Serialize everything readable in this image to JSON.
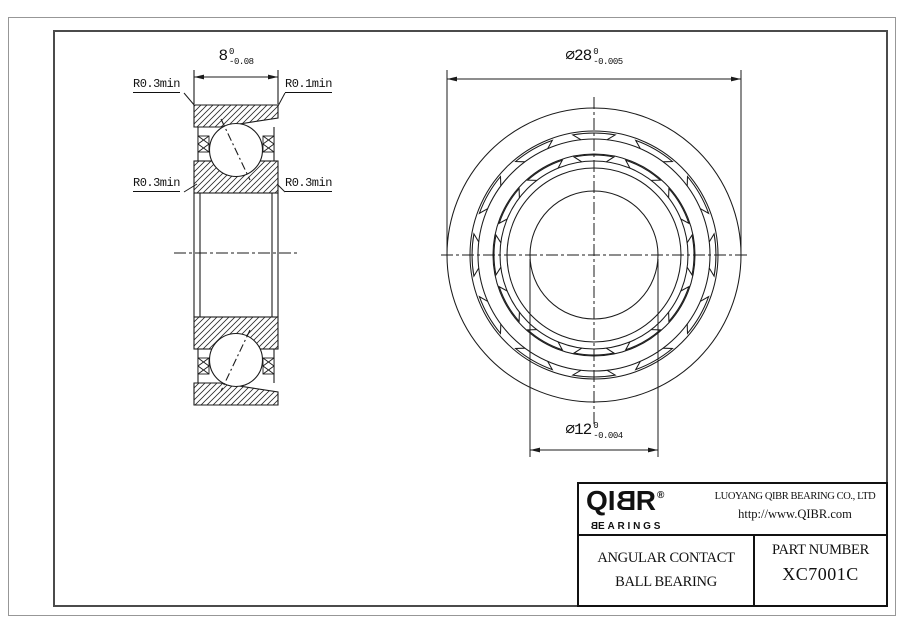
{
  "section_view": {
    "width_dim": {
      "value": "8",
      "upper": "0",
      "lower": "-0.08"
    },
    "callouts": {
      "top_left": "R0.3min",
      "top_right": "R0.1min",
      "mid_left": "R0.3min",
      "mid_right": "R0.3min"
    }
  },
  "front_view": {
    "od_dim": {
      "value": "⌀28",
      "upper": "0",
      "lower": "-0.005"
    },
    "bore_dim": {
      "value": "⌀12",
      "upper": "0",
      "lower": "-0.004"
    }
  },
  "title_block": {
    "logo": {
      "part1": "QI",
      "part2": "B",
      "part3": "R",
      "registered": "®",
      "sub_part1": "B",
      "sub_part2": "EARINGS"
    },
    "company": "LUOYANG QIBR BEARING CO., LTD",
    "website": "http://www.QIBR.com",
    "product": {
      "line1": "ANGULAR CONTACT",
      "line2": "BALL BEARING"
    },
    "part_number": {
      "label": "PART NUMBER",
      "value": "XC7001C"
    }
  },
  "colors": {
    "line": "#1b1b1b",
    "frame_outer": "#979797",
    "frame_inner": "#4b4b4b"
  }
}
